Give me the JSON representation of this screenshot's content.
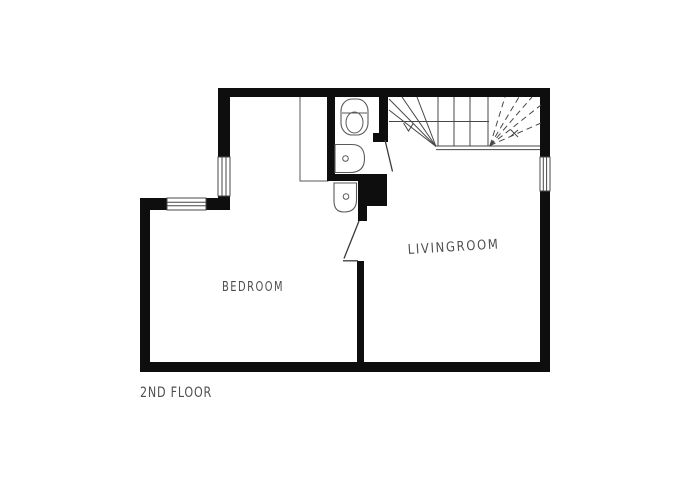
{
  "page": {
    "background": "#ffffff"
  },
  "floor_plan": {
    "floor_label": "2ND FLOOR",
    "rooms": {
      "bedroom": "BEDROOM",
      "livingroom": "LIVINGROOM"
    },
    "colors": {
      "wall": "#0e0e0e",
      "thin_line": "#474747",
      "fixture_line": "#5a5a5a",
      "label_text": "#4f4f4f",
      "background": "#ffffff"
    },
    "fixtures": [
      "staircase",
      "toilet",
      "sink",
      "sink",
      "closet",
      "window",
      "window",
      "window",
      "door",
      "door"
    ]
  }
}
